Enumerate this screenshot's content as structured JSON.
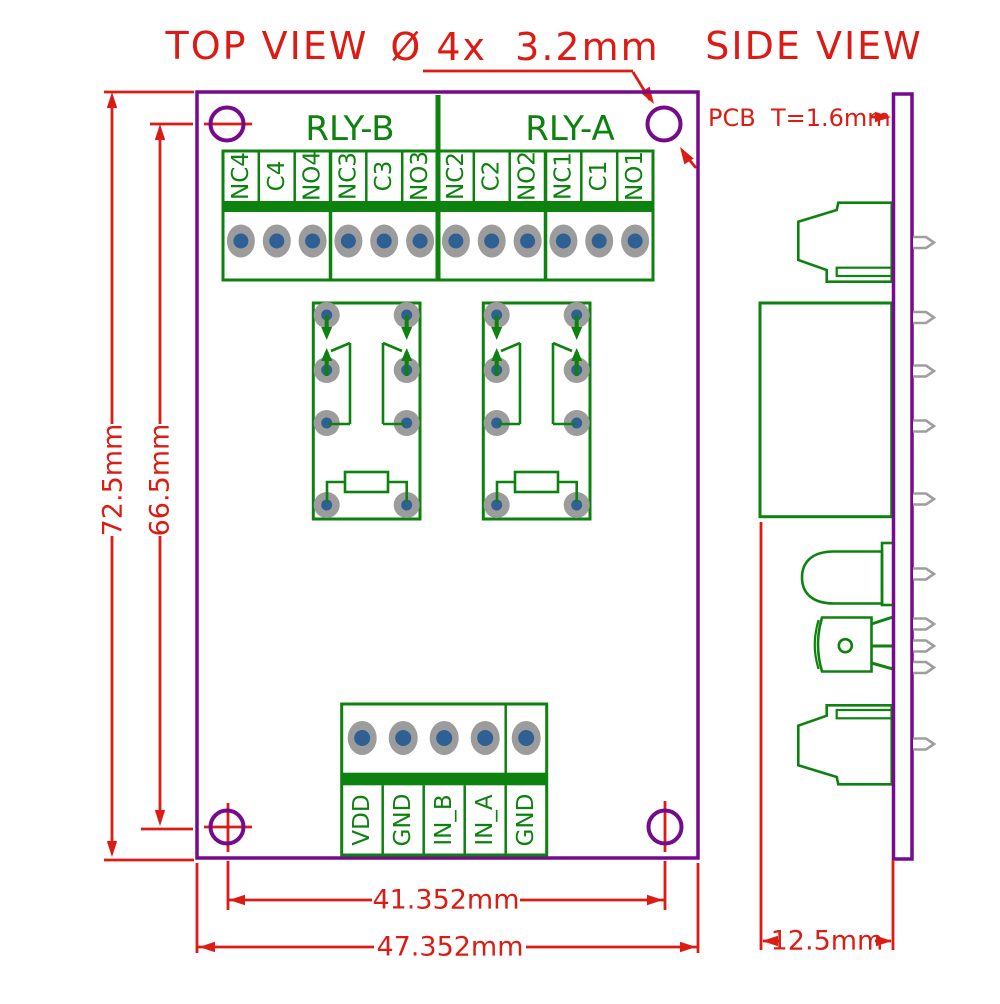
{
  "colors": {
    "red": "#dc1c14",
    "purple": "#750a8c",
    "green": "#0e820e",
    "pad_gray": "#9c9c9c",
    "pad_blue": "#2f6093",
    "pin_gray": "#9e9e9e"
  },
  "top_view": {
    "title": "TOP VIEW",
    "hole_callout": "Ø 4x  3.2mm",
    "relay_labels": {
      "b": "RLY-B",
      "a": "RLY-A"
    },
    "relay_terminals": [
      "NC4",
      "C4",
      "NO4",
      "NC3",
      "C3",
      "NO3",
      "NC2",
      "C2",
      "NO2",
      "NC1",
      "C1",
      "NO1"
    ],
    "control_terminals": [
      "VDD",
      "GND",
      "IN_B",
      "IN_A",
      "GND"
    ],
    "dims": {
      "board_height": "72.5mm",
      "hole_pitch_vertical": "66.5mm",
      "hole_pitch_horizontal": "41.352mm",
      "board_width": "47.352mm"
    }
  },
  "side_view": {
    "title": "SIDE VIEW",
    "pcb_thickness_label": "PCB  T=1.6mm",
    "depth_dim": "12.5mm"
  }
}
